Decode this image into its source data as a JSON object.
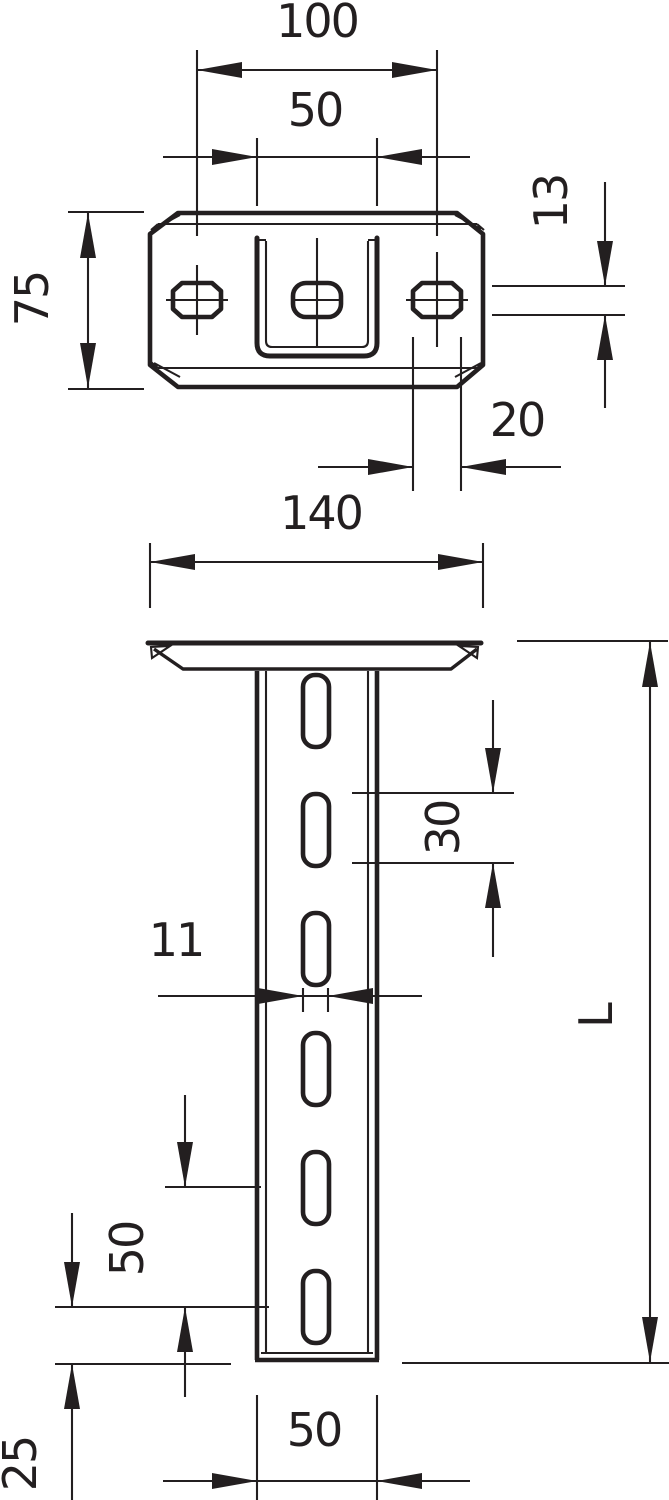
{
  "drawing": {
    "kind": "technical dimension drawing",
    "views": [
      "head-plate top view",
      "support post front view"
    ],
    "line_color": "#231f20",
    "background_color": "#ffffff"
  },
  "dims": {
    "slot_spacing_top": "100",
    "channel_width_top": "50",
    "head_plate_depth": "75",
    "side_slot_height": "13",
    "side_slot_length": "20",
    "head_plate_width": "140",
    "web_hole_length": "30",
    "web_hole_width": "11",
    "web_hole_pitch": "50",
    "web_hole_end_distance": "25",
    "profile_width": "50",
    "overall_length": "L"
  },
  "dimension_values": {
    "slot_spacing_top_mm": 100,
    "channel_width_top_mm": 50,
    "head_plate_depth_mm": 75,
    "side_slot_height_mm": 13,
    "side_slot_length_mm": 20,
    "head_plate_width_mm": 140,
    "web_hole_length_mm": 30,
    "web_hole_width_mm": 11,
    "web_hole_pitch_mm": 50,
    "web_hole_end_distance_mm": 25,
    "profile_width_mm": 50,
    "overall_length": "L"
  }
}
